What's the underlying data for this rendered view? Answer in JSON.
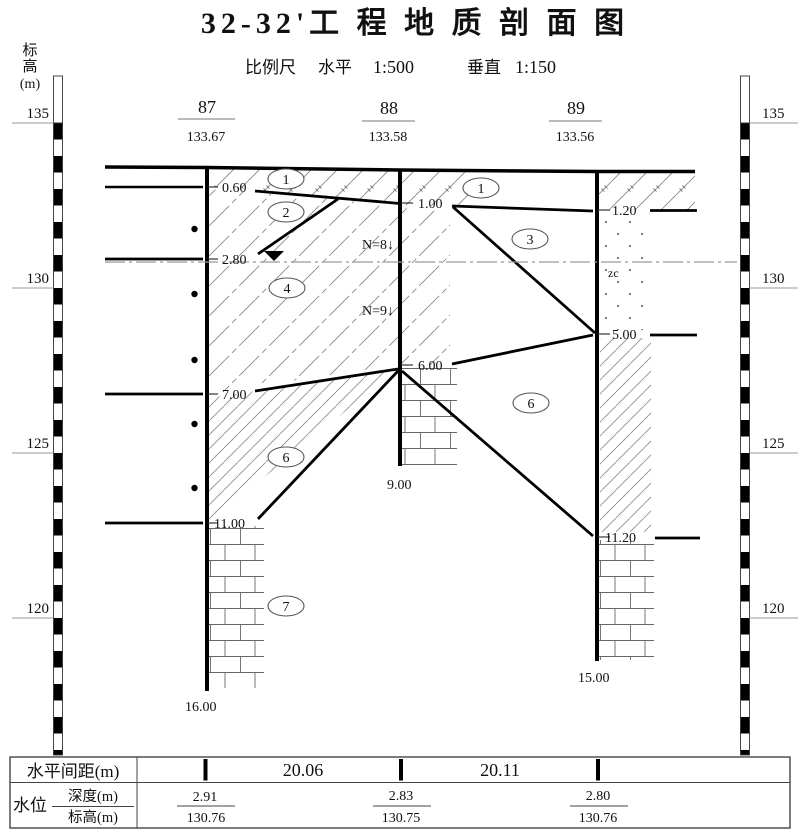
{
  "title": "32-32'工 程 地 质 剖 面 图",
  "scale": {
    "label": "比例尺",
    "horizontal": "水平",
    "horizontal_ratio": "1:500",
    "vertical": "垂直",
    "vertical_ratio": "1:150"
  },
  "axis": {
    "char1": "标",
    "char2": "高",
    "unit": "(m)",
    "ticks": [
      "135",
      "130",
      "125",
      "120"
    ]
  },
  "boreholes": [
    {
      "id": "87",
      "elevation": "133.67",
      "d0": "0.60",
      "d1": "2.80",
      "d2": "7.00",
      "d3": "11.00",
      "bottom": "16.00"
    },
    {
      "id": "88",
      "elevation": "133.58",
      "d0": "1.00",
      "d1": "6.00",
      "bottom": "9.00"
    },
    {
      "id": "89",
      "elevation": "133.56",
      "d0": "1.20",
      "d1": "5.00",
      "d2": "11.20",
      "bottom": "15.00"
    }
  ],
  "layers": {
    "c1a": "1",
    "c2": "2",
    "c1b": "1",
    "c3": "3",
    "c4": "4",
    "c6a": "6",
    "c6b": "6",
    "c7": "7"
  },
  "annotations": {
    "spt1": "N=8↓",
    "spt2": "N=9↓",
    "zc": "zc"
  },
  "table": {
    "spacing_label": "水平间距(m)",
    "spacing1": "20.06",
    "spacing2": "20.11",
    "water_label": "水位",
    "depth_label": "深度(m)",
    "elevation_label": "标高(m)",
    "w1_depth": "2.91",
    "w1_elev": "130.76",
    "w2_depth": "2.83",
    "w2_elev": "130.75",
    "w3_depth": "2.80",
    "w3_elev": "130.76"
  },
  "colors": {
    "line": "#000000",
    "hatch": "#8a8a8a",
    "water_line": "#9a9a9a"
  }
}
